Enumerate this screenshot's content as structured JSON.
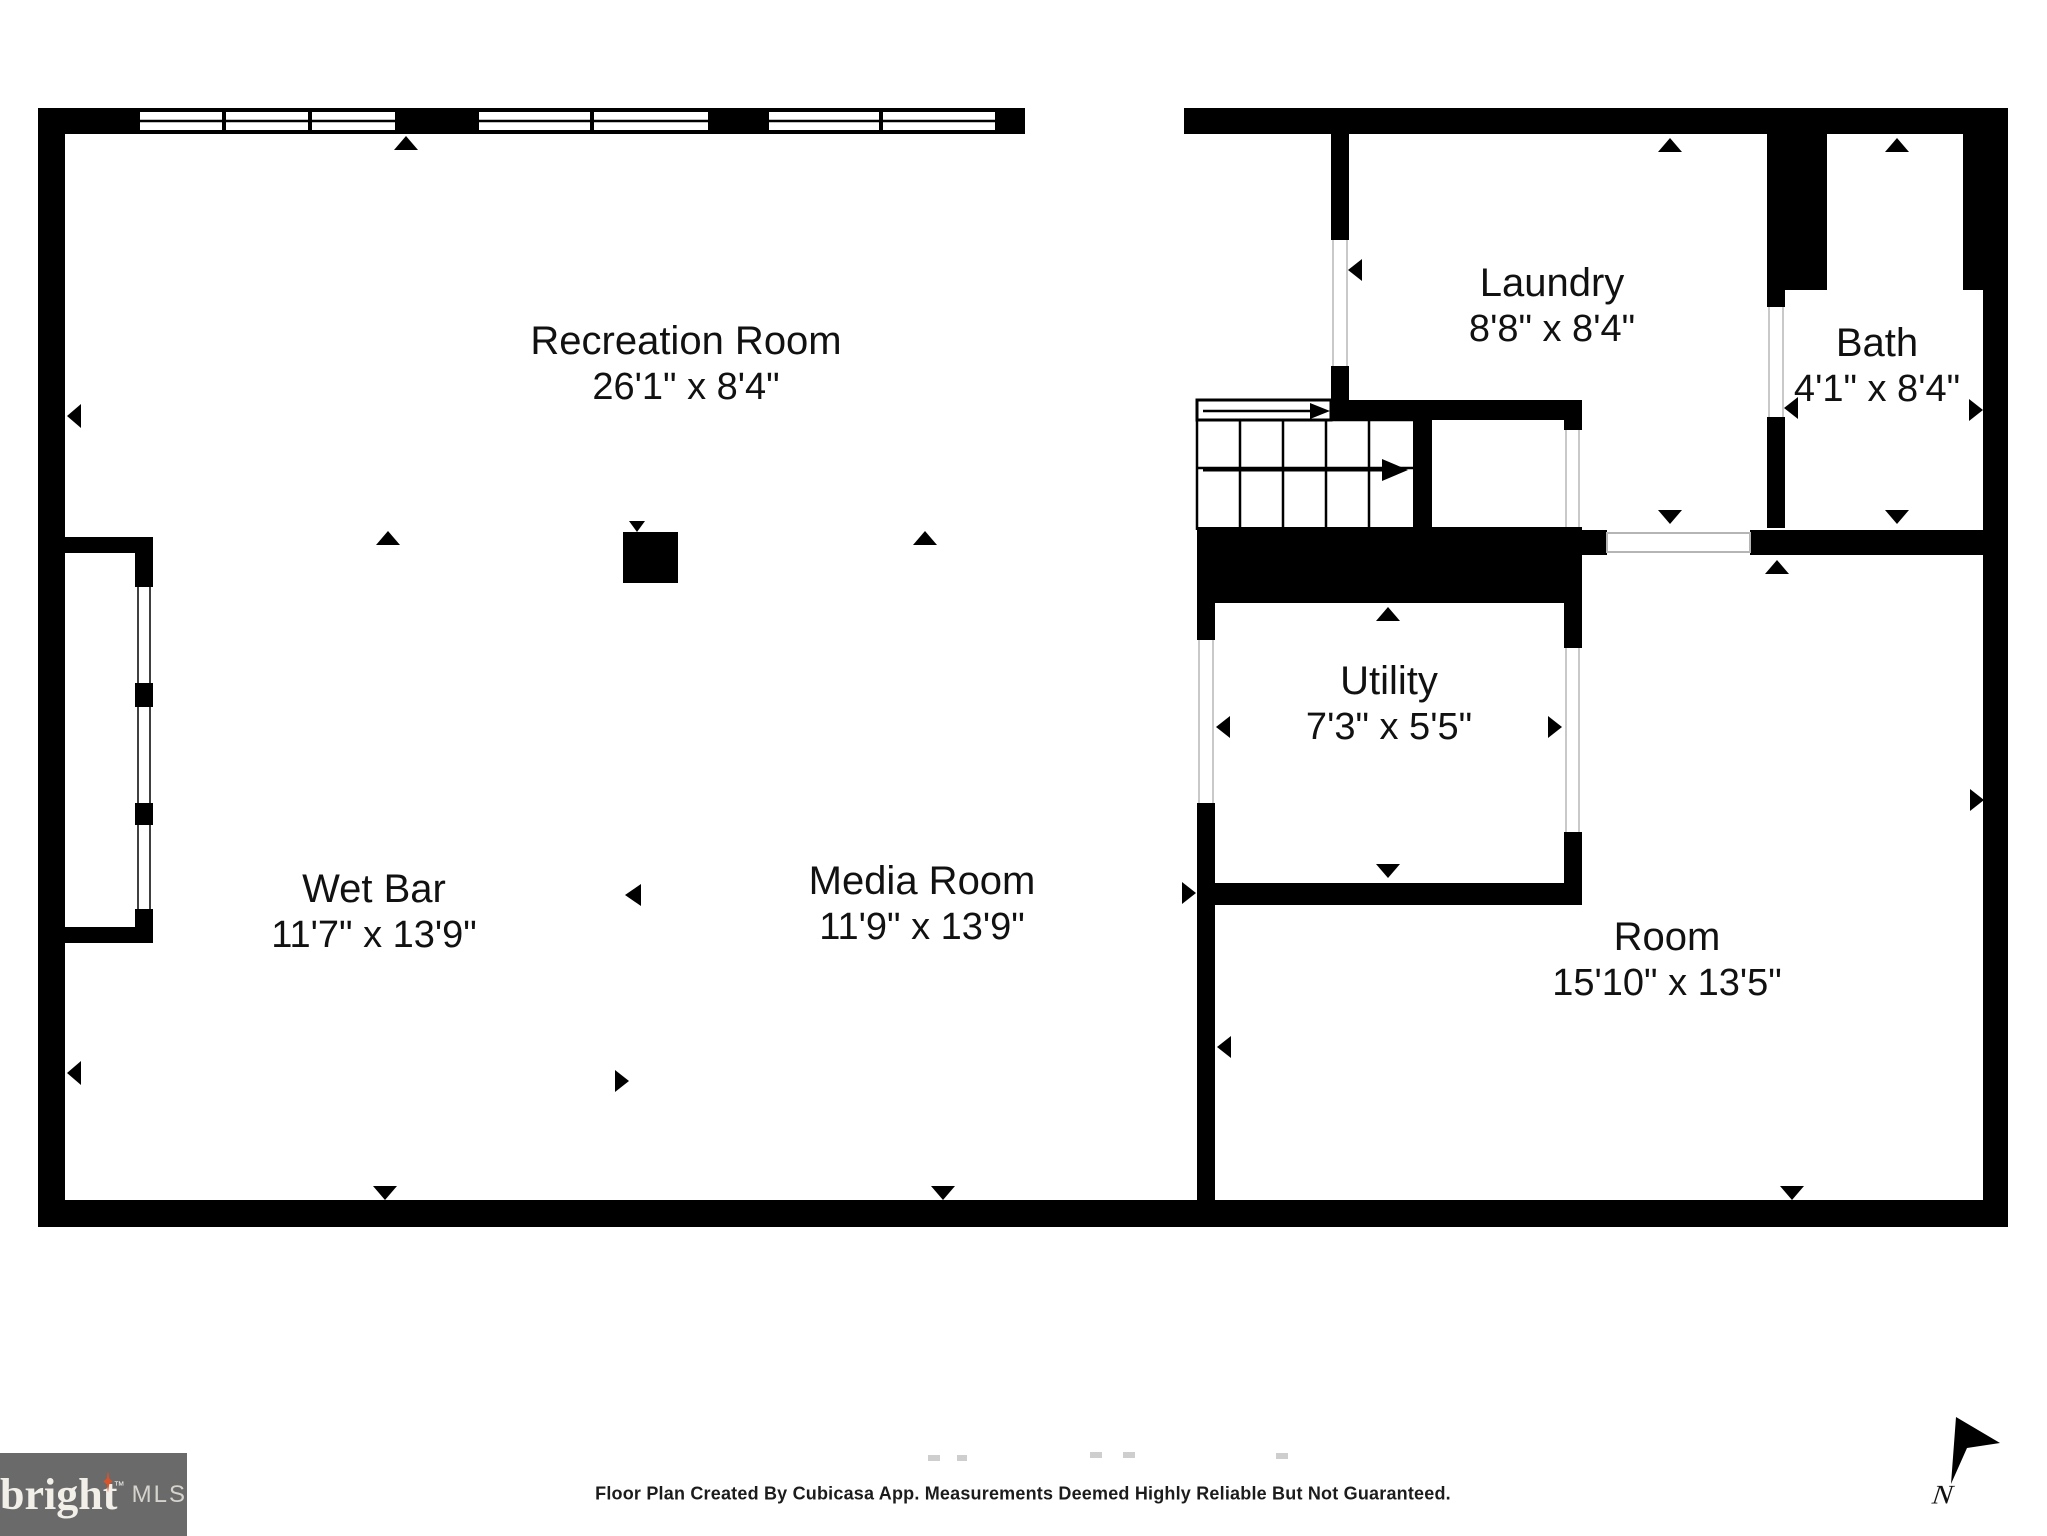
{
  "rooms": [
    {
      "id": "recreation-room",
      "name": "Recreation Room",
      "dims": "26'1\" x 8'4\""
    },
    {
      "id": "laundry",
      "name": "Laundry",
      "dims": "8'8\" x 8'4\""
    },
    {
      "id": "bath",
      "name": "Bath",
      "dims": "4'1\" x 8'4\""
    },
    {
      "id": "utility",
      "name": "Utility",
      "dims": "7'3\" x 5'5\""
    },
    {
      "id": "wet-bar",
      "name": "Wet Bar",
      "dims": "11'7\" x 13'9\""
    },
    {
      "id": "media-room",
      "name": "Media Room",
      "dims": "11'9\" x 13'9\""
    },
    {
      "id": "room",
      "name": "Room",
      "dims": "15'10\" x 13'5\""
    }
  ],
  "footer": {
    "disclaimer": "Floor Plan Created By Cubicasa App. Measurements Deemed Highly Reliable But Not Guaranteed."
  },
  "logo": {
    "brand": "bright",
    "tm": "™",
    "suffix": "MLS",
    "box_color": "#6a6a6a",
    "brand_color": "#f2efe9",
    "suffix_color": "#d6d3cd",
    "star_color": "#d9542b"
  },
  "compass": {
    "label": "N"
  },
  "colors": {
    "walls": "#000000",
    "floor": "#ffffff",
    "opening_jamb": "#c9c9c9",
    "faint_marks": "#c6c6c6"
  }
}
